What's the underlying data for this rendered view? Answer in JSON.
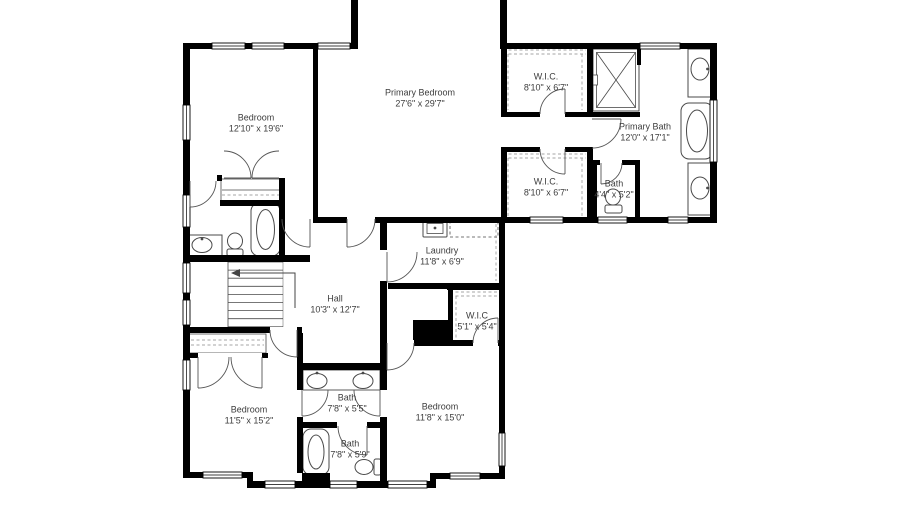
{
  "plan": {
    "type": "floor-plan",
    "floor_note": "second floor residential plan, cropped at top",
    "colors": {
      "wall": "#000000",
      "label": "#3d3d3d",
      "fixture": "#4a4a4a",
      "background": "#ffffff"
    }
  },
  "rooms": [
    {
      "name": "Bedroom",
      "dims": "12'10\" x 19'6\"",
      "cx": 256,
      "cy": 123
    },
    {
      "name": "Primary Bedroom",
      "dims": "27'6\" x 29'7\"",
      "cx": 420,
      "cy": 98
    },
    {
      "name": "W.I.C.",
      "dims": "8'10\" x 6'7\"",
      "cx": 546,
      "cy": 82
    },
    {
      "name": "Primary Bath",
      "dims": "12'0\" x 17'1\"",
      "cx": 645,
      "cy": 132
    },
    {
      "name": "W.I.C.",
      "dims": "8'10\" x 6'7\"",
      "cx": 546,
      "cy": 187
    },
    {
      "name": "Bath",
      "dims": "4'4\" x 5'2\"",
      "cx": 614,
      "cy": 189
    },
    {
      "name": "Laundry",
      "dims": "11'8\" x 6'9\"",
      "cx": 442,
      "cy": 256
    },
    {
      "name": "Hall",
      "dims": "10'3\" x 12'7\"",
      "cx": 335,
      "cy": 304
    },
    {
      "name": "W.I.C",
      "dims": "5'1\" x 5'4\"",
      "cx": 477,
      "cy": 321
    },
    {
      "name": "Bedroom",
      "dims": "11'5\" x 15'2\"",
      "cx": 249,
      "cy": 415
    },
    {
      "name": "Bath",
      "dims": "7'8\" x 5'5\"",
      "cx": 347,
      "cy": 403
    },
    {
      "name": "Bath",
      "dims": "7'8\" x 5'9\"",
      "cx": 350,
      "cy": 449
    },
    {
      "name": "Bedroom",
      "dims": "11'8\" x 15'0\"",
      "cx": 440,
      "cy": 412
    }
  ]
}
